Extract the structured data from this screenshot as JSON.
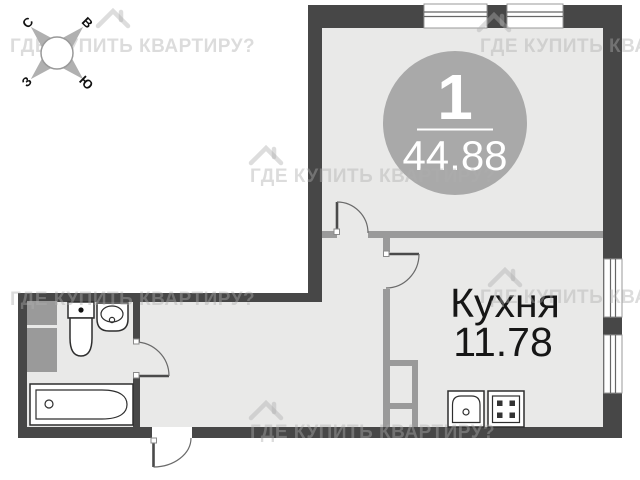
{
  "plan": {
    "badge": {
      "number": "1",
      "area": "44.88"
    },
    "rooms": [
      {
        "name": "Кухня",
        "area": "11.78"
      }
    ],
    "compass": {
      "north": "С",
      "east": "В",
      "west": "З",
      "south": "Ю"
    },
    "watermark": {
      "text": "ГДЕ КУПИТЬ КВАРТИРУ?"
    },
    "icons": [
      "compass-rose-icon",
      "house-watermark-icon",
      "window-icon",
      "door-arc-icon",
      "toilet-icon",
      "washbasin-icon",
      "bathtub-icon",
      "kitchen-sink-icon",
      "stove-icon"
    ],
    "colors": {
      "wall": "#474747",
      "partition": "#9a9a9a",
      "floor": "#e9e9e8",
      "badge": "#a9a9a9",
      "watermark": "#aeaeae"
    }
  }
}
